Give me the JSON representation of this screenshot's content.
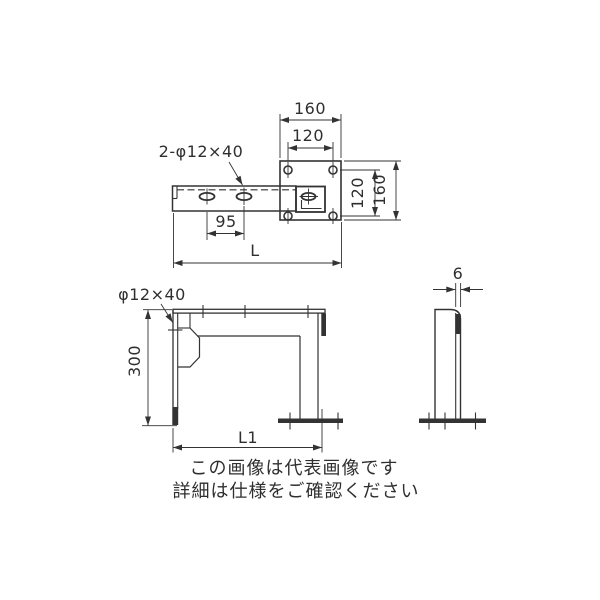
{
  "drawing": {
    "top_view": {
      "slot_callout": "2-φ12×40",
      "plate_width": "160",
      "hole_pitch_horizontal": "120",
      "hole_pitch_vertical": "120",
      "plate_height": "160",
      "slot_pitch": "95",
      "arm_length": "L"
    },
    "front_view": {
      "slot_callout": "φ12×40",
      "post_height": "300",
      "overall_length": "L1"
    },
    "side_view": {
      "plate_thickness": "6"
    }
  },
  "notice": {
    "line1": "この画像は代表画像です",
    "line2": "詳細は仕様をご確認ください"
  },
  "colors": {
    "line": "#333333",
    "text": "#2f2f2f",
    "background": "#ffffff"
  }
}
